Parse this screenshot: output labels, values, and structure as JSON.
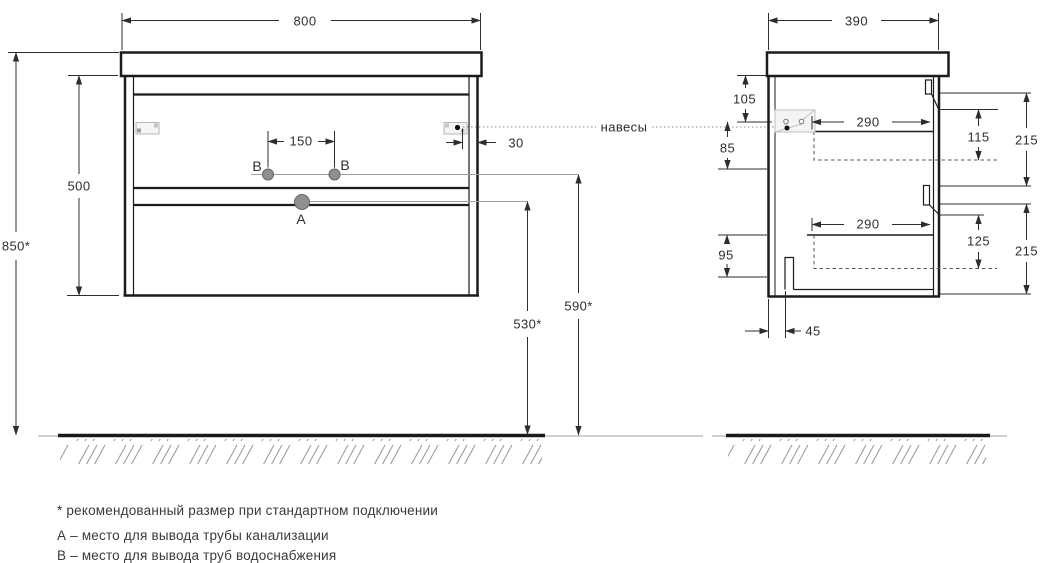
{
  "front_view": {
    "dim_width": "800",
    "dim_carcass_height": "500",
    "dim_mounting_height": "850*",
    "dim_supply_spacing": "150",
    "dim_hanger_offset": "30",
    "dim_drain_outlet_height": "530*",
    "dim_supply_outlet_height": "590*",
    "point_a_label": "А",
    "point_b_left_label": "В",
    "point_b_right_label": "В"
  },
  "side_view": {
    "dim_depth": "390",
    "dim_hanger_from_top": "105",
    "dim_hanger_to_supply": "85",
    "dim_drawer_top_depth": "290",
    "dim_drawer_top_clearance": "115",
    "dim_drawer_top_front": "215",
    "dim_drawer_bottom_depth": "290",
    "dim_drawer_bottom_clearance": "125",
    "dim_drawer_bottom_front": "215",
    "dim_bottom_section": "95",
    "dim_drain_from_back": "45",
    "hangers_label": "навесы"
  },
  "footnotes": {
    "recommended_size": "* рекомендованный размер при стандартном подключении",
    "point_a": "А – место для вывода трубы канализации",
    "point_b": "В – место для вывода труб водоснабжения"
  }
}
